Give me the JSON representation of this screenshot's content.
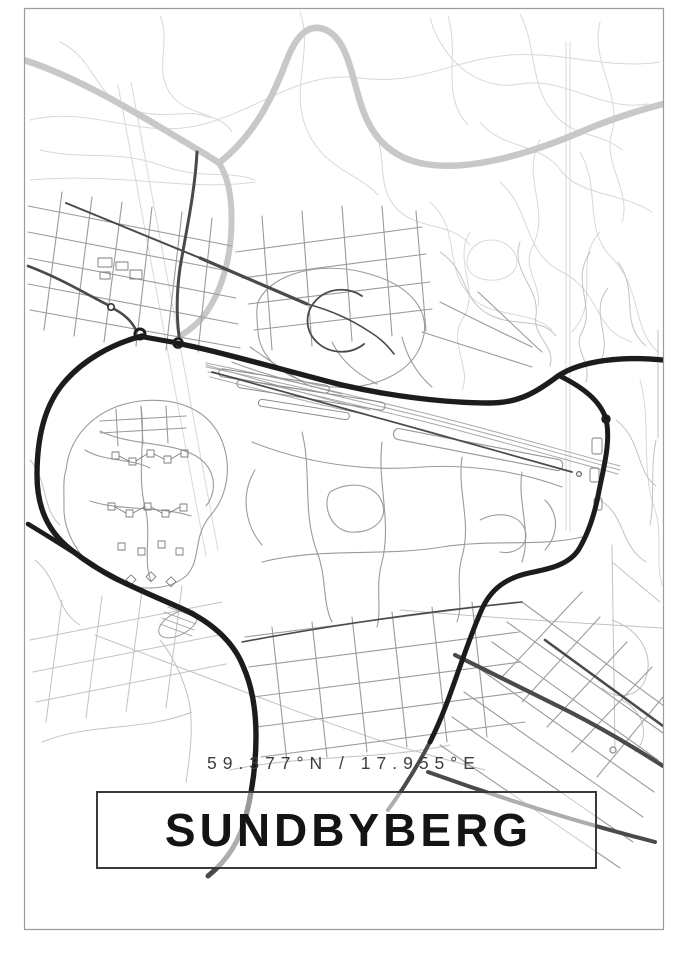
{
  "poster": {
    "title": "SUNDBYBERG",
    "coordinates": "59.377°N / 17.955°E",
    "colors": {
      "background": "#ffffff",
      "frame_border": "#9c9c9c",
      "title_text": "#141414",
      "box_border": "#3a3a3a",
      "coords_text": "#3d3d3d",
      "road_major": "#1c1c1c",
      "road_dark": "#4a4a4a",
      "road_medium": "#9b9b9b",
      "road_minor": "#c2c2c2",
      "road_faint": "#d8d8d8",
      "highway_light": "#c8c8c8",
      "rail": "#a9a9a9"
    }
  }
}
